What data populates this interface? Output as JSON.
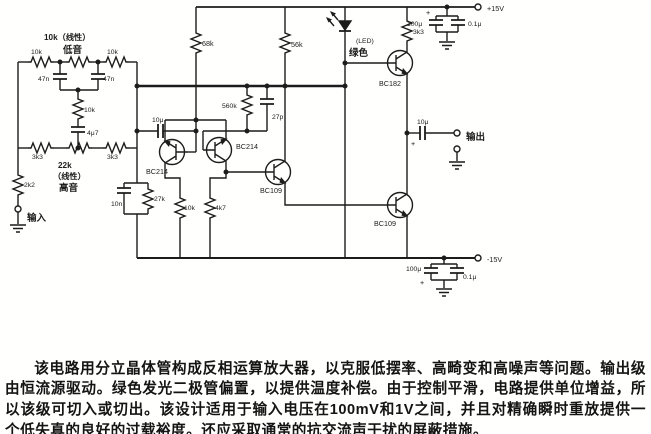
{
  "io": {
    "input": "输入",
    "output": "输出"
  },
  "tone": {
    "bass_title": "10k（线性）",
    "bass_sub": "低音",
    "r_top_left": "10k",
    "r_top_right": "10k",
    "c_left": "47n",
    "c_right": "47n",
    "r_mid": "10k",
    "c_mid": "4μ7",
    "r_bot_left": "3k3",
    "r_bot_right": "3k3",
    "r_input": "2k2",
    "treble_value": "22k",
    "treble_kind": "（线性）",
    "treble_sub": "高音",
    "c_treble": "10n",
    "r_treble": "27k"
  },
  "amp": {
    "c_in": "10μ",
    "r_tail": "68k",
    "r_load": "56k",
    "r_fb": "560k",
    "c_fb": "27p",
    "q1": "BC214",
    "q2": "BC214",
    "q3": "BC109",
    "r_c1": "10k",
    "r_c2": "4k7"
  },
  "output_stage": {
    "led_label": "(LED)",
    "led_color": "绿色",
    "r_cs": "3k3",
    "q4": "BC182",
    "q5": "BC109",
    "c_out": "10μ",
    "plus": "+"
  },
  "power": {
    "v_pos": "+15V",
    "v_neg": "-15V",
    "c_top1": "100μ",
    "c_top2": "0.1μ",
    "plus_top": "+",
    "c_bot1": "100μ",
    "c_bot2": "0.1μ",
    "plus_bot": "+"
  },
  "description": {
    "text": "该电路用分立晶体管构成反相运算放大器，以克服低摆率、高畸变和高噪声等问题。输出级由恒流源驱动。绿色发光二极管偏置，以提供温度补偿。由于控制平滑，电路提供单位增益，所以该级可切入或切出。该设计适用于输入电压在100mV和1V之间，并且对精确瞬时重放提供一个低失真的良好的过载裕度。还应采取通常的抗交流声干扰的屏蔽措施。"
  },
  "colors": {
    "ink": "#1c1c1c",
    "paper": "#fffffe"
  }
}
